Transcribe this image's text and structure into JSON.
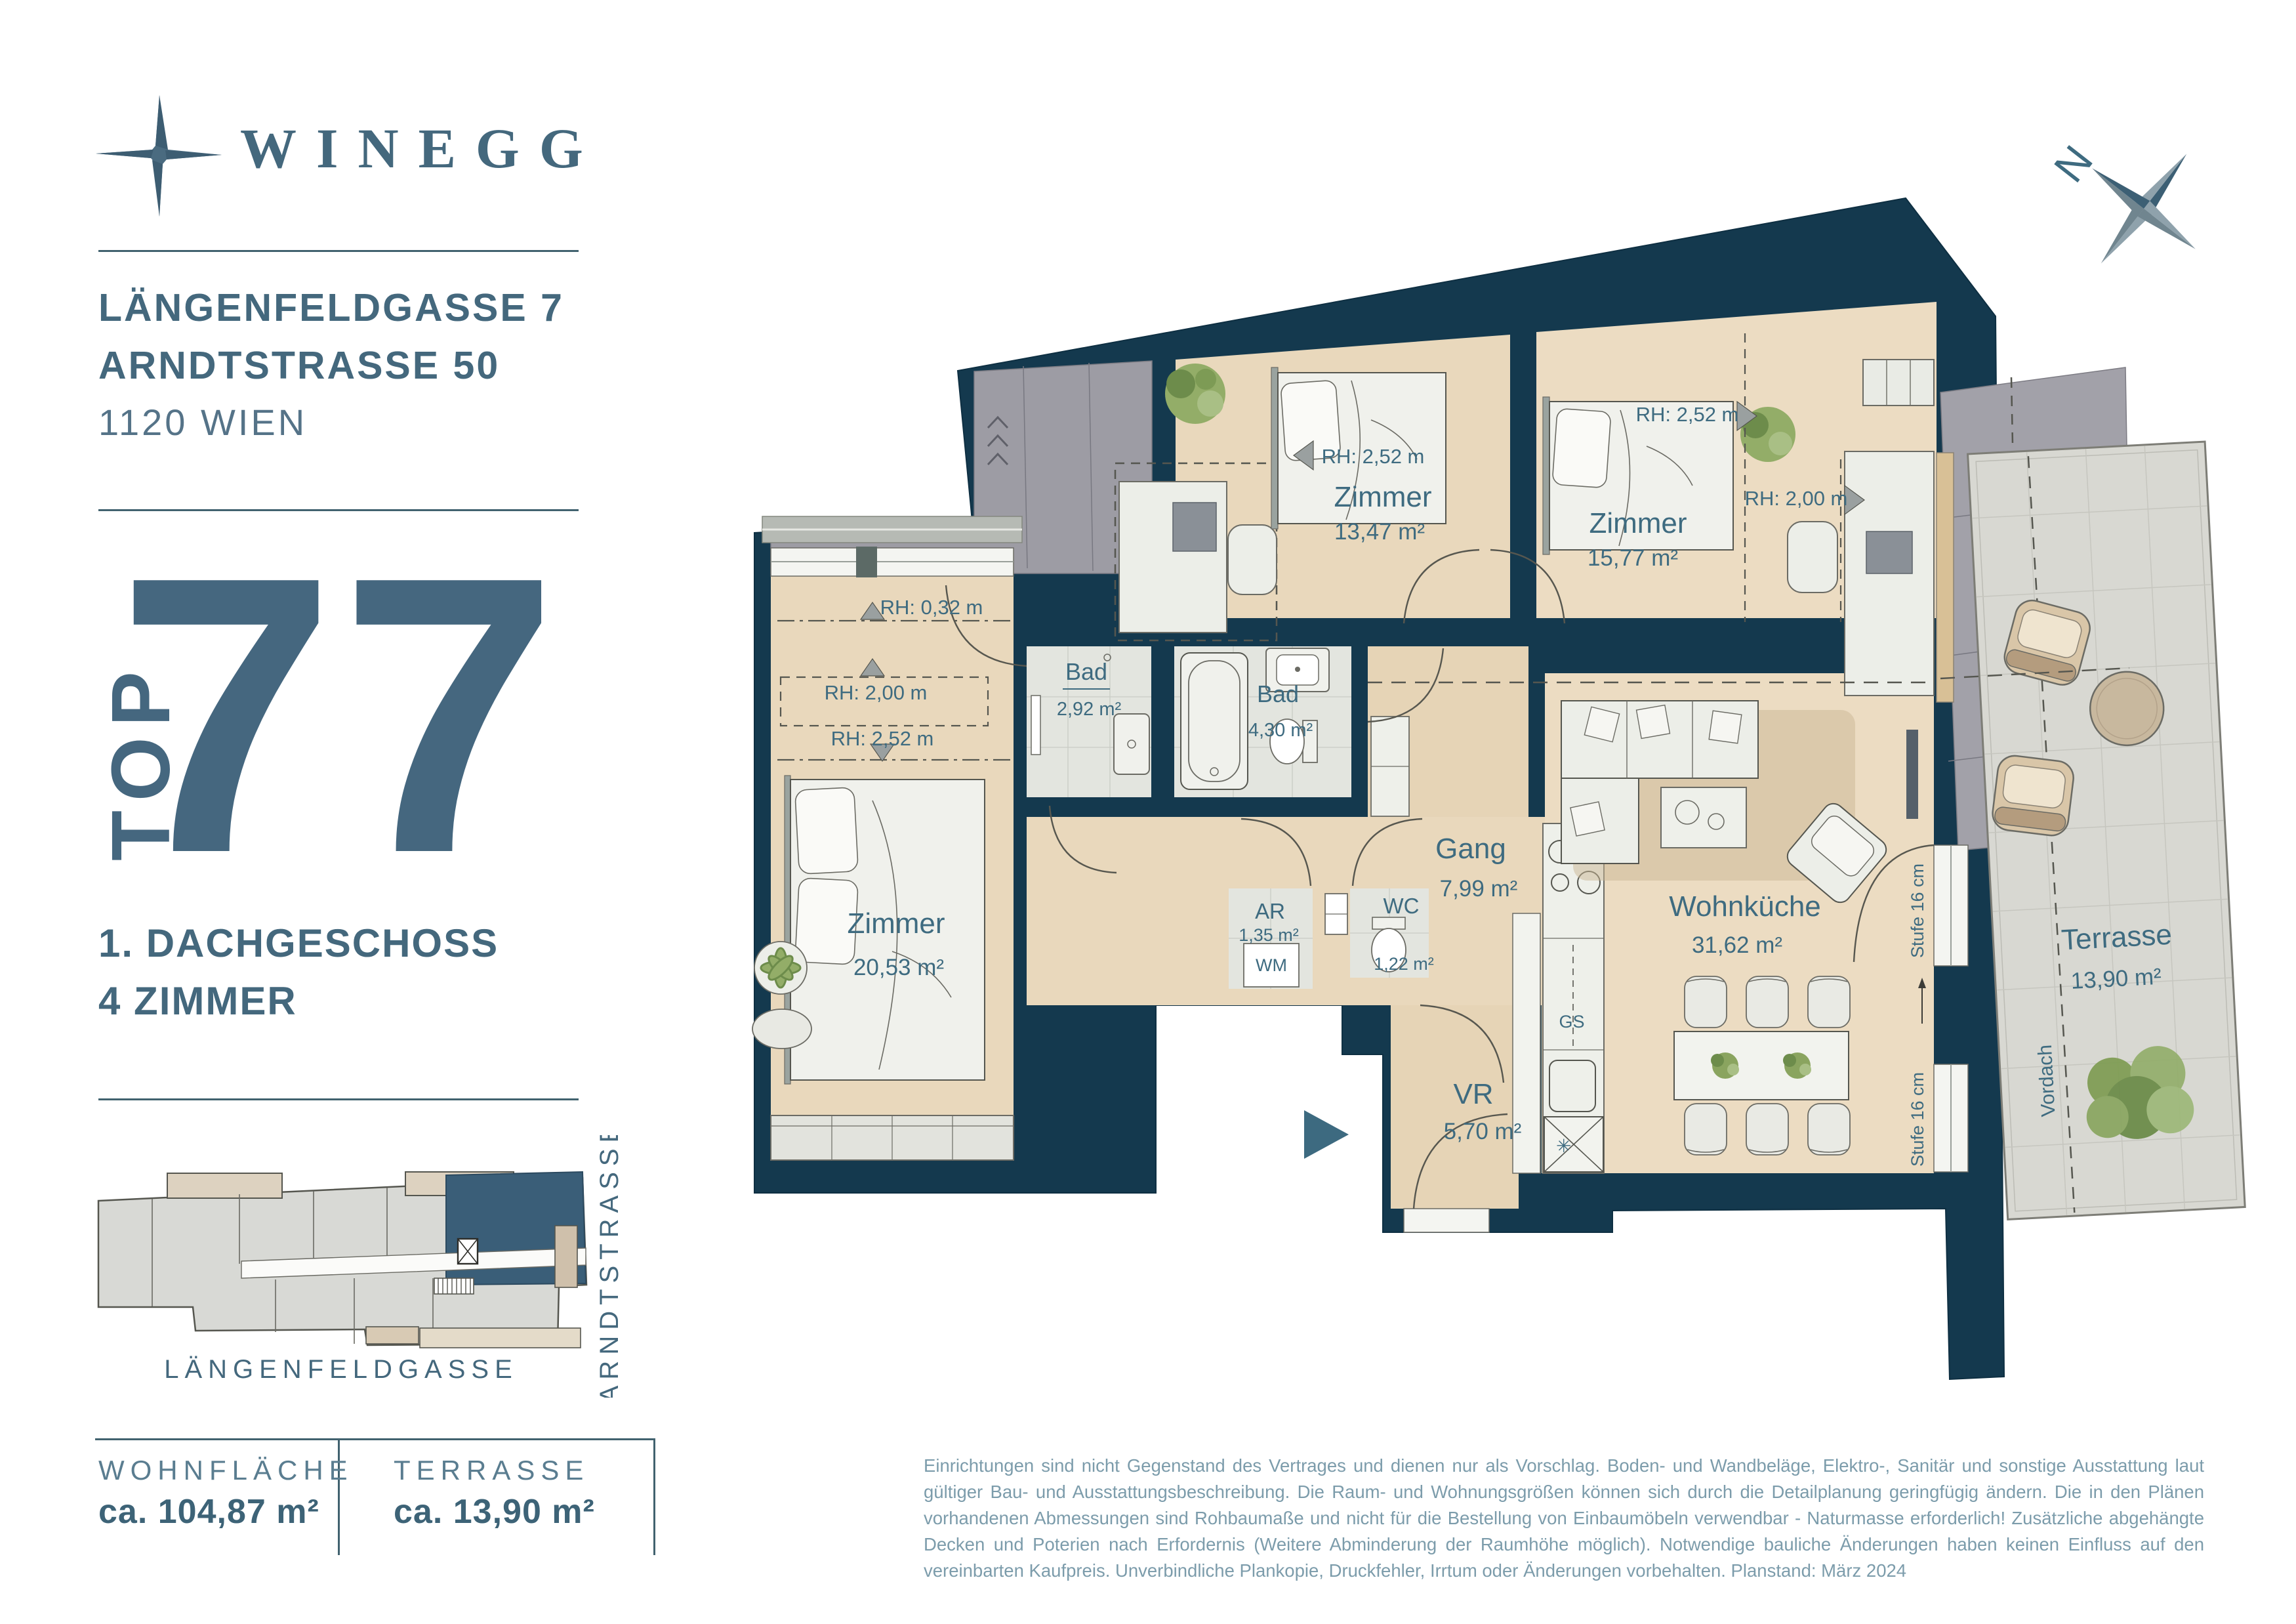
{
  "brand": {
    "name": "WINEGG"
  },
  "project": {
    "address_line1": "LÄNGENFELDGASSE 7",
    "address_line2": "ARNDTSTRASSE 50",
    "city": "1120 WIEN",
    "top_label": "TOP",
    "top_number": "77",
    "floor": "1. DACHGESCHOSS",
    "rooms_count": "4 ZIMMER"
  },
  "site_plan": {
    "street_bottom": "LÄNGENFELDGASSE",
    "street_right": "ARNDTSTRASSE"
  },
  "compass": {
    "north": "N"
  },
  "plan": {
    "rooms": [
      {
        "name": "Zimmer",
        "area": "13,47 m²"
      },
      {
        "name": "Zimmer",
        "area": "15,77 m²"
      },
      {
        "name": "Zimmer",
        "area": "20,53 m²"
      },
      {
        "name": "Bad",
        "area": "2,92 m²"
      },
      {
        "name": "Bad",
        "area": "4,30 m²"
      },
      {
        "name": "Gang",
        "area": "7,99 m²"
      },
      {
        "name": "AR",
        "area": "1,35 m²"
      },
      {
        "name": "WC",
        "area": "1,22 m²"
      },
      {
        "name": "VR",
        "area": "5,70 m²"
      },
      {
        "name": "Wohnküche",
        "area": "31,62 m²"
      },
      {
        "name": "Terrasse",
        "area": "13,90 m²"
      }
    ],
    "annotations": {
      "rh_252": "RH: 2,52 m",
      "rh_200": "RH: 2,00 m",
      "rh_032": "RH: 0,32 m",
      "wm": "WM",
      "gs": "GS",
      "stufe": "Stufe 16 cm",
      "vordach": "Vordach"
    }
  },
  "footer": {
    "wohnflaeche_label": "WOHNFLÄCHE",
    "wohnflaeche_value": "ca. 104,87 m²",
    "terrasse_label": "TERRASSE",
    "terrasse_value": "ca. 13,90 m²",
    "disclaimer": "Einrichtungen sind nicht Gegenstand des Vertrages und dienen nur als Vorschlag. Boden- und Wandbeläge, Elektro-, Sanitär und sonstige Ausstattung laut gültiger Bau- und Ausstattungsbeschreibung. Die Raum- und Wohnungsgrößen können sich durch die Detailplanung geringfügig ändern. Die in den Plänen vorhandenen Abmessungen sind Rohbaumaße und nicht für die Bestellung von Einbaumöbeln verwendbar - Naturmasse erforderlich! Zusätzliche abgehängte Decken und Poterien nach Erfordernis (Weitere Abminderung der Raumhöhe möglich). Notwendige bauliche Änderungen haben keinen Einfluss auf den vereinbarten Kaufpreis. Unverbindliche Plankopie, Druckfehler, Irrtum oder Änderungen vorbehalten. Planstand: März 2024"
  },
  "colors": {
    "accent": "#45677f",
    "wall": "#14394e",
    "floor": "#e9d8bc",
    "tile": "#e3e5df",
    "roof_gray": "#9d9ca4",
    "terrace": "#d8d8d2",
    "highlight_unit": "#3a5e78",
    "label": "#3e6b80"
  }
}
